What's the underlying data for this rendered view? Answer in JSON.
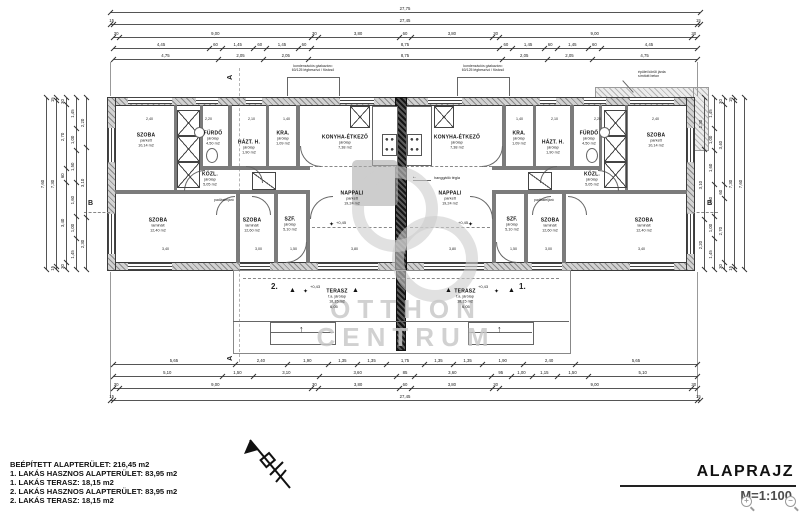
{
  "colors": {
    "wall": "#777777",
    "center_wall": "#222222",
    "watermark": "#c9c9c9",
    "ink": "#1a1a1a"
  },
  "watermark": {
    "line1": "OTTHON",
    "line2": "CENTRUM"
  },
  "title_block": {
    "title": "ALAPRAJZ",
    "scale": "M=1:100"
  },
  "legend": {
    "lines": [
      "BEÉPÍTETT ALAPTERÜLET: 216,45 m2",
      "1. LAKÁS HASZNOS ALAPTERÜLET: 83,95 m2",
      "1. LAKÁS TERASZ: 18,15 m2",
      "2. LAKÁS HASZNOS ALAPTERÜLET: 83,95 m2",
      "2. LAKÁS TERASZ: 18,15 m2"
    ]
  },
  "icons": {
    "zoom_in": "+",
    "zoom_out": "−",
    "up_arrow": "↑",
    "entry_triangle": "▲",
    "star": "✦",
    "arrow_left": "←"
  },
  "plan": {
    "rooms": [
      {
        "name": "SZOBA",
        "floor": "parkett",
        "area": "10,14 m2",
        "x": 146,
        "y": 140
      },
      {
        "name": "FÜRDŐ",
        "floor": "járólap",
        "area": "4,50 m2",
        "x": 213,
        "y": 138
      },
      {
        "name": "HÁZT. H.",
        "floor": "járólap",
        "area": "1,90 m2",
        "x": 249,
        "y": 147
      },
      {
        "name": "KRA.",
        "floor": "járólap",
        "area": "1,09 m2",
        "x": 283,
        "y": 138
      },
      {
        "name": "KONYHA-ÉTKEZŐ",
        "floor": "járólap",
        "area": "7,38 m2",
        "x": 345,
        "y": 142
      },
      {
        "name": "KÖZL.",
        "floor": "járólap",
        "area": "5,05 m2",
        "x": 210,
        "y": 179
      },
      {
        "name": "NAPPALI",
        "floor": "parkett",
        "area": "19,24 m2",
        "x": 352,
        "y": 198
      },
      {
        "name": "SZOBA",
        "floor": "laminált",
        "area": "12,40 m2",
        "x": 158,
        "y": 225
      },
      {
        "name": "SZOBA",
        "floor": "laminált",
        "area": "12,60 m2",
        "x": 252,
        "y": 225
      },
      {
        "name": "SZF.",
        "floor": "járólap",
        "area": "5,10 m2",
        "x": 290,
        "y": 224
      },
      {
        "name": "TERASZ",
        "floor": "f.a. járólap",
        "area": "18,15 m2",
        "x": 337,
        "y": 296
      },
      {
        "name": "SZOBA",
        "floor": "parkett",
        "area": "10,14 m2",
        "x": 656,
        "y": 140
      },
      {
        "name": "FÜRDŐ",
        "floor": "járólap",
        "area": "4,50 m2",
        "x": 589,
        "y": 138
      },
      {
        "name": "HÁZT. H.",
        "floor": "járólap",
        "area": "1,90 m2",
        "x": 553,
        "y": 147
      },
      {
        "name": "KRA.",
        "floor": "járólap",
        "area": "1,09 m2",
        "x": 519,
        "y": 138
      },
      {
        "name": "KONYHA-ÉTKEZŐ",
        "floor": "járólap",
        "area": "7,38 m2",
        "x": 457,
        "y": 142
      },
      {
        "name": "KÖZL.",
        "floor": "járólap",
        "area": "5,05 m2",
        "x": 592,
        "y": 179
      },
      {
        "name": "NAPPALI",
        "floor": "parkett",
        "area": "19,24 m2",
        "x": 450,
        "y": 198
      },
      {
        "name": "SZOBA",
        "floor": "laminált",
        "area": "12,40 m2",
        "x": 644,
        "y": 225
      },
      {
        "name": "SZOBA",
        "floor": "laminált",
        "area": "12,60 m2",
        "x": 550,
        "y": 225
      },
      {
        "name": "SZF.",
        "floor": "járólap",
        "area": "5,10 m2",
        "x": 512,
        "y": 224
      },
      {
        "name": "TERASZ",
        "floor": "f.a. járólap",
        "area": "18,15 m2",
        "x": 465,
        "y": 296
      }
    ],
    "notes": [
      {
        "text": "kondenzációs gázkazán=\n60/125 légbeszívó / füstcső",
        "x": 313,
        "y": 64,
        "size": 3.5,
        "align": "center"
      },
      {
        "text": "kondenzációs gázkazán=\n60/125 légbeszívó / füstcső",
        "x": 483,
        "y": 64,
        "size": 3.5,
        "align": "center"
      },
      {
        "text": "épület körüli járda\nsímított beton",
        "x": 638,
        "y": 70,
        "size": 3.5
      },
      {
        "text": "hanggátló tégla",
        "x": 434,
        "y": 176,
        "size": 3.8
      },
      {
        "text": "padlásfeljáró",
        "x": 214,
        "y": 198,
        "size": 3.5
      },
      {
        "text": "padlásfeljáró",
        "x": 534,
        "y": 198,
        "size": 3.5
      },
      {
        "text": "+0,43",
        "x": 310,
        "y": 284,
        "size": 4
      },
      {
        "text": "+0,43",
        "x": 478,
        "y": 284,
        "size": 4
      },
      {
        "text": "+0,45",
        "x": 336,
        "y": 220,
        "size": 4
      },
      {
        "text": "+0,45",
        "x": 458,
        "y": 220,
        "size": 4
      },
      {
        "text": "6,05",
        "x": 330,
        "y": 304,
        "size": 4
      },
      {
        "text": "6,05",
        "x": 462,
        "y": 304,
        "size": 4
      },
      {
        "text": "2.",
        "x": 271,
        "y": 282,
        "size": 8,
        "bold": true
      },
      {
        "text": "1.",
        "x": 519,
        "y": 282,
        "size": 8,
        "bold": true
      },
      {
        "text": "A",
        "x": 229,
        "y": 73,
        "size": 7,
        "bold": true,
        "rot": -90
      },
      {
        "text": "A",
        "x": 229,
        "y": 354,
        "size": 7,
        "bold": true,
        "rot": -90
      },
      {
        "text": "B",
        "x": 88,
        "y": 200,
        "size": 7,
        "bold": true
      },
      {
        "text": "B",
        "x": 707,
        "y": 200,
        "size": 7,
        "bold": true
      },
      {
        "text": "2,40",
        "x": 146,
        "y": 117,
        "size": 3.6
      },
      {
        "text": "2,20",
        "x": 205,
        "y": 117,
        "size": 3.6
      },
      {
        "text": "2,10",
        "x": 248,
        "y": 117,
        "size": 3.6
      },
      {
        "text": "1,40",
        "x": 283,
        "y": 117,
        "size": 3.6
      },
      {
        "text": "1,40",
        "x": 516,
        "y": 117,
        "size": 3.6
      },
      {
        "text": "2,10",
        "x": 551,
        "y": 117,
        "size": 3.6
      },
      {
        "text": "2,20",
        "x": 594,
        "y": 117,
        "size": 3.6
      },
      {
        "text": "2,40",
        "x": 652,
        "y": 117,
        "size": 3.6
      },
      {
        "text": "3,40",
        "x": 162,
        "y": 247,
        "size": 3.6
      },
      {
        "text": "3,00",
        "x": 255,
        "y": 247,
        "size": 3.6
      },
      {
        "text": "1,50",
        "x": 290,
        "y": 247,
        "size": 3.6
      },
      {
        "text": "3,80",
        "x": 351,
        "y": 247,
        "size": 3.6
      },
      {
        "text": "3,80",
        "x": 449,
        "y": 247,
        "size": 3.6
      },
      {
        "text": "1,50",
        "x": 510,
        "y": 247,
        "size": 3.6
      },
      {
        "text": "3,00",
        "x": 545,
        "y": 247,
        "size": 3.6
      },
      {
        "text": "3,40",
        "x": 638,
        "y": 247,
        "size": 3.6
      }
    ],
    "markers": [
      {
        "icon": "entry_triangle",
        "x": 289,
        "y": 287,
        "size": 7
      },
      {
        "icon": "entry_triangle",
        "x": 352,
        "y": 287,
        "size": 7
      },
      {
        "icon": "entry_triangle",
        "x": 445,
        "y": 287,
        "size": 7
      },
      {
        "icon": "entry_triangle",
        "x": 508,
        "y": 287,
        "size": 7
      },
      {
        "icon": "star",
        "x": 303,
        "y": 289,
        "size": 6
      },
      {
        "icon": "star",
        "x": 494,
        "y": 289,
        "size": 6
      },
      {
        "icon": "star",
        "x": 329,
        "y": 222,
        "size": 6
      },
      {
        "icon": "star",
        "x": 468,
        "y": 222,
        "size": 6
      },
      {
        "icon": "up_arrow",
        "x": 299,
        "y": 325,
        "size": 9
      },
      {
        "icon": "up_arrow",
        "x": 497,
        "y": 325,
        "size": 9
      },
      {
        "icon": "arrow_left",
        "x": 412,
        "y": 175,
        "size": 5
      }
    ],
    "dimension_chains": [
      {
        "dir": "h",
        "x": 110,
        "y": 12,
        "len": 590,
        "values": [
          "27,75"
        ]
      },
      {
        "dir": "h",
        "x": 110,
        "y": 24,
        "len": 590,
        "values": [
          "15",
          "27,45",
          "15"
        ]
      },
      {
        "dir": "h",
        "x": 113,
        "y": 37,
        "len": 584,
        "values": [
          "30",
          "9,00",
          "30",
          "3,80",
          "60",
          "3,80",
          "30",
          "9,00",
          "30"
        ]
      },
      {
        "dir": "h",
        "x": 113,
        "y": 48,
        "len": 584,
        "values": [
          "4,45",
          "60",
          "1,45",
          "60",
          "1,45",
          "60",
          "8,75",
          "60",
          "1,45",
          "60",
          "1,45",
          "60",
          "4,45"
        ]
      },
      {
        "dir": "h",
        "x": 113,
        "y": 59,
        "len": 584,
        "values": [
          "4,75",
          "2,05",
          "2,05",
          "8,75",
          "2,05",
          "2,05",
          "4,75"
        ]
      },
      {
        "dir": "h",
        "x": 113,
        "y": 364,
        "len": 584,
        "values": [
          "5,65",
          "2,40",
          "1,90",
          "1,35",
          "1,35",
          "1,75",
          "1,35",
          "1,35",
          "1,90",
          "2,40",
          "5,65"
        ]
      },
      {
        "dir": "h",
        "x": 113,
        "y": 376,
        "len": 584,
        "values": [
          "5,10",
          "1,50",
          "3,10",
          "3,60",
          "85",
          "3,60",
          "95",
          "1,00",
          "1,15",
          "1,50",
          "5,10"
        ]
      },
      {
        "dir": "h",
        "x": 113,
        "y": 388,
        "len": 584,
        "values": [
          "30",
          "9,00",
          "30",
          "3,80",
          "60",
          "3,80",
          "30",
          "9,00",
          "30"
        ]
      },
      {
        "dir": "h",
        "x": 110,
        "y": 400,
        "len": 590,
        "values": [
          "15",
          "27,45",
          "15"
        ]
      },
      {
        "dir": "v",
        "x": 46,
        "y": 98,
        "len": 172,
        "values": [
          "7,60"
        ]
      },
      {
        "dir": "v",
        "x": 56,
        "y": 98,
        "len": 172,
        "values": [
          "15",
          "7,30",
          "15"
        ]
      },
      {
        "dir": "v",
        "x": 66,
        "y": 98,
        "len": 172,
        "values": [
          "30",
          "3,40",
          "60",
          "2,70",
          "30"
        ]
      },
      {
        "dir": "v",
        "x": 76,
        "y": 98,
        "len": 172,
        "values": [
          "1,45",
          "1,00",
          "1,60",
          "1,50",
          "1,00",
          "1,45"
        ]
      },
      {
        "dir": "v",
        "x": 86,
        "y": 98,
        "len": 172,
        "values": [
          "2,30",
          "3,10",
          "2,20"
        ]
      },
      {
        "dir": "v",
        "x": 704,
        "y": 98,
        "len": 172,
        "values": [
          "2,20",
          "3,10",
          "2,30"
        ]
      },
      {
        "dir": "v",
        "x": 714,
        "y": 98,
        "len": 172,
        "values": [
          "1,45",
          "1,00",
          "1,50",
          "1,60",
          "1,00",
          "1,45"
        ]
      },
      {
        "dir": "v",
        "x": 724,
        "y": 98,
        "len": 172,
        "values": [
          "30",
          "2,70",
          "60",
          "3,40",
          "30"
        ]
      },
      {
        "dir": "v",
        "x": 734,
        "y": 98,
        "len": 172,
        "values": [
          "15",
          "7,30",
          "15"
        ]
      },
      {
        "dir": "v",
        "x": 744,
        "y": 98,
        "len": 172,
        "values": [
          "7,60"
        ]
      }
    ]
  }
}
